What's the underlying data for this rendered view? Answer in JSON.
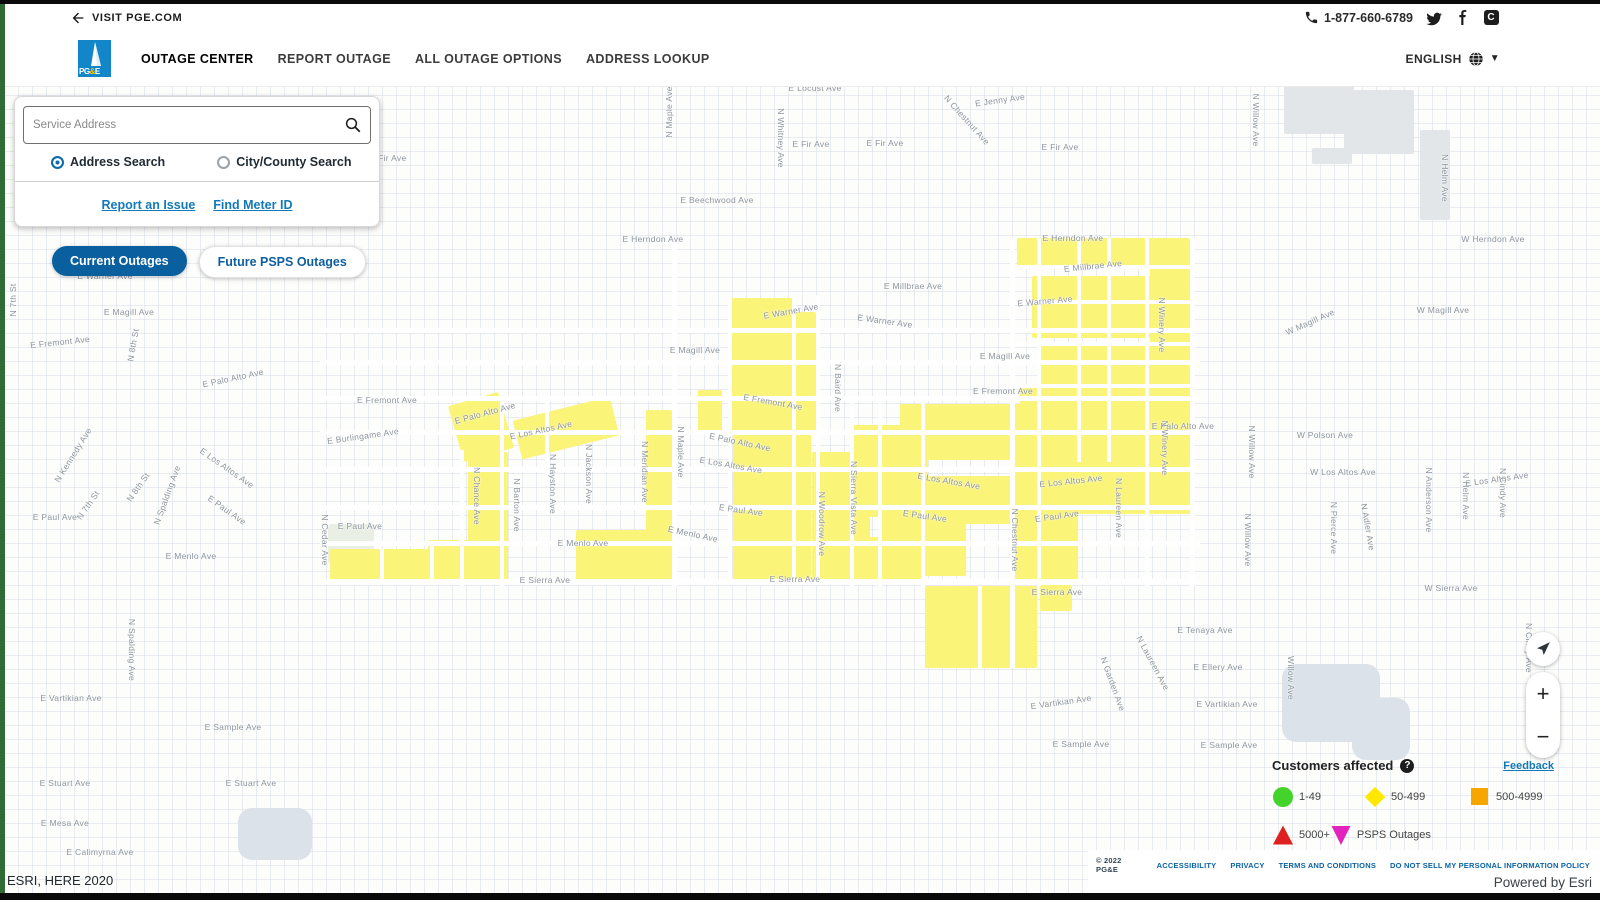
{
  "topbar": {
    "back_label": "VISIT PGE.COM",
    "phone": "1-877-660-6789"
  },
  "header": {
    "logo_text": "PG&E",
    "nav": [
      "OUTAGE CENTER",
      "REPORT OUTAGE",
      "ALL OUTAGE OPTIONS",
      "ADDRESS LOOKUP"
    ],
    "language": "ENGLISH"
  },
  "search": {
    "placeholder": "Service Address",
    "radio_address": "Address Search",
    "radio_city": "City/County Search",
    "link_report": "Report an Issue",
    "link_meter": "Find Meter ID"
  },
  "toggles": {
    "current": "Current Outages",
    "future": "Future PSPS Outages"
  },
  "controls": {
    "zoom_in": "+",
    "zoom_out": "−"
  },
  "legend": {
    "title": "Customers affected",
    "help": "?",
    "feedback": "Feedback",
    "items": [
      {
        "shape": "circle",
        "color": "#43d32b",
        "label": "1-49",
        "w": 92
      },
      {
        "shape": "diamond",
        "color": "#ffe800",
        "label": "50-499",
        "w": 105
      },
      {
        "shape": "square",
        "color": "#f7a600",
        "label": "500-4999",
        "w": 91
      },
      {
        "shape": "triangle-up",
        "color": "#df2020",
        "label": "5000+",
        "w": 0
      },
      {
        "shape": "triangle-down",
        "color": "#e323be",
        "label": "PSPS Outages",
        "w": 120
      }
    ],
    "resource_link": "Community Resource Center"
  },
  "footer": {
    "copyright": "© 2022 PG&E",
    "links": [
      "ACCESSIBILITY",
      "PRIVACY",
      "TERMS AND CONDITIONS",
      "DO NOT SELL MY PERSONAL INFORMATION POLICY"
    ],
    "powered": "Powered by Esri"
  },
  "map": {
    "attribution": "ESRI, HERE 2020",
    "colors": {
      "outage": "#faf478",
      "street": "#ffffff",
      "building": "#e3e6e9",
      "water": "#dbe2ea",
      "green": "#e9efe4"
    },
    "outage_areas": [
      [
        455,
        398,
        52,
        58,
        -16
      ],
      [
        468,
        452,
        40,
        128
      ],
      [
        428,
        540,
        56,
        44
      ],
      [
        330,
        549,
        100,
        36
      ],
      [
        516,
        408,
        100,
        40,
        -14
      ],
      [
        576,
        530,
        92,
        54
      ],
      [
        646,
        410,
        26,
        172
      ],
      [
        698,
        390,
        24,
        42
      ],
      [
        730,
        298,
        64,
        136
      ],
      [
        796,
        312,
        20,
        120
      ],
      [
        733,
        432,
        78,
        148
      ],
      [
        812,
        452,
        58,
        128
      ],
      [
        865,
        537,
        58,
        46
      ],
      [
        852,
        425,
        76,
        92
      ],
      [
        900,
        404,
        292,
        56
      ],
      [
        1010,
        452,
        182,
        62
      ],
      [
        902,
        476,
        112,
        48
      ],
      [
        878,
        498,
        88,
        78
      ],
      [
        1014,
        498,
        64,
        84
      ],
      [
        925,
        586,
        112,
        82
      ],
      [
        1040,
        585,
        32,
        26
      ],
      [
        1017,
        238,
        172,
        28
      ],
      [
        1150,
        238,
        40,
        190
      ],
      [
        1032,
        276,
        150,
        62
      ],
      [
        1040,
        345,
        145,
        52
      ],
      [
        1020,
        388,
        168,
        36
      ],
      [
        1163,
        250,
        30,
        24
      ]
    ],
    "street_channels": [
      [
        320,
        328,
        880,
        5
      ],
      [
        320,
        360,
        880,
        5
      ],
      [
        320,
        396,
        880,
        5
      ],
      [
        320,
        430,
        880,
        5
      ],
      [
        320,
        467,
        880,
        5
      ],
      [
        320,
        505,
        880,
        5
      ],
      [
        320,
        541,
        880,
        5
      ],
      [
        320,
        579,
        880,
        6
      ],
      [
        1008,
        265,
        190,
        4
      ],
      [
        1008,
        300,
        190,
        4
      ],
      [
        1008,
        342,
        190,
        4
      ],
      [
        1008,
        384,
        190,
        4
      ],
      [
        672,
        240,
        5,
        346
      ],
      [
        728,
        295,
        4,
        290
      ],
      [
        792,
        295,
        4,
        290
      ],
      [
        816,
        295,
        4,
        290
      ],
      [
        850,
        400,
        4,
        186
      ],
      [
        878,
        400,
        4,
        186
      ],
      [
        921,
        400,
        4,
        186
      ],
      [
        1010,
        238,
        5,
        430
      ],
      [
        1037,
        238,
        4,
        348
      ],
      [
        1077,
        238,
        4,
        224
      ],
      [
        1107,
        238,
        4,
        224
      ],
      [
        1145,
        238,
        4,
        348
      ],
      [
        1190,
        238,
        5,
        348
      ],
      [
        500,
        400,
        4,
        186
      ],
      [
        545,
        400,
        4,
        80
      ],
      [
        460,
        450,
        4,
        136
      ],
      [
        978,
        586,
        4,
        82
      ],
      [
        430,
        545,
        4,
        40
      ],
      [
        380,
        549,
        4,
        36
      ]
    ],
    "buildings": [
      [
        1284,
        82,
        70,
        52
      ],
      [
        1344,
        90,
        70,
        64
      ],
      [
        1420,
        130,
        30,
        90
      ],
      [
        1312,
        148,
        40,
        16
      ]
    ],
    "water": [
      [
        1282,
        664,
        98,
        78
      ],
      [
        1352,
        698,
        58,
        62
      ],
      [
        238,
        808,
        74,
        52
      ]
    ],
    "green_areas": [
      [
        328,
        524,
        46,
        40
      ]
    ],
    "labels": [
      {
        "t": "E Locust Ave",
        "x": 810,
        "y": 88
      },
      {
        "t": "N Maple Ave",
        "x": 664,
        "y": 112,
        "r": -90
      },
      {
        "t": "E Jenny Ave",
        "x": 995,
        "y": 100,
        "r": -8
      },
      {
        "t": "N Chestnut Ave",
        "x": 962,
        "y": 120,
        "r": 48
      },
      {
        "t": "E Fir Ave",
        "x": 806,
        "y": 144
      },
      {
        "t": "E Fir Ave",
        "x": 880,
        "y": 143
      },
      {
        "t": "E Fir Ave",
        "x": 1055,
        "y": 147
      },
      {
        "t": "E Fir Ave",
        "x": 383,
        "y": 158
      },
      {
        "t": "N Whitney Ave",
        "x": 776,
        "y": 138,
        "r": 90
      },
      {
        "t": "E Beechwood Ave",
        "x": 712,
        "y": 200
      },
      {
        "t": "N Willow Ave",
        "x": 1251,
        "y": 120,
        "r": 90
      },
      {
        "t": "N Helm Ave",
        "x": 1440,
        "y": 178,
        "r": 90
      },
      {
        "t": "W Herndon Ave",
        "x": 1488,
        "y": 239
      },
      {
        "t": "E Herndon Ave",
        "x": 648,
        "y": 239
      },
      {
        "t": "E Herndon Ave",
        "x": 1068,
        "y": 238
      },
      {
        "t": "E Millbrae Ave",
        "x": 908,
        "y": 286
      },
      {
        "t": "E Millbrae Ave",
        "x": 1088,
        "y": 266,
        "r": -6
      },
      {
        "t": "E Warner Ave",
        "x": 100,
        "y": 276
      },
      {
        "t": "E Warner Ave",
        "x": 786,
        "y": 311,
        "r": -10
      },
      {
        "t": "E Warner Ave",
        "x": 880,
        "y": 321,
        "r": 8
      },
      {
        "t": "E Warner Ave",
        "x": 1040,
        "y": 301,
        "r": -5
      },
      {
        "t": "E Magill Ave",
        "x": 124,
        "y": 312
      },
      {
        "t": "E Magill Ave",
        "x": 690,
        "y": 350
      },
      {
        "t": "E Magill Ave",
        "x": 1000,
        "y": 356
      },
      {
        "t": "W Magill Ave",
        "x": 1305,
        "y": 322,
        "r": -24
      },
      {
        "t": "W Magill Ave",
        "x": 1438,
        "y": 310
      },
      {
        "t": "E Fremont Ave",
        "x": 55,
        "y": 342,
        "r": -6
      },
      {
        "t": "E Fremont Ave",
        "x": 382,
        "y": 400
      },
      {
        "t": "E Fremont Ave",
        "x": 768,
        "y": 402,
        "r": 10
      },
      {
        "t": "E Fremont Ave",
        "x": 998,
        "y": 391
      },
      {
        "t": "N 7th St",
        "x": 8,
        "y": 300,
        "r": -90
      },
      {
        "t": "N 8th St",
        "x": 128,
        "y": 345,
        "r": -80
      },
      {
        "t": "N Kennedy Ave",
        "x": 68,
        "y": 455,
        "r": -58
      },
      {
        "t": "E Palo Alto Ave",
        "x": 228,
        "y": 378,
        "r": -12
      },
      {
        "t": "E Palo Alto Ave",
        "x": 480,
        "y": 413,
        "r": -15
      },
      {
        "t": "E Palo Alto Ave",
        "x": 735,
        "y": 442,
        "r": 12
      },
      {
        "t": "E Palo Alto Ave",
        "x": 1178,
        "y": 426
      },
      {
        "t": "E Burlingame Ave",
        "x": 358,
        "y": 436,
        "r": -8
      },
      {
        "t": "E Los Altos Ave",
        "x": 536,
        "y": 430,
        "r": -12
      },
      {
        "t": "E Los Altos Ave",
        "x": 222,
        "y": 468,
        "r": 35
      },
      {
        "t": "E Los Altos Ave",
        "x": 726,
        "y": 465,
        "r": 10
      },
      {
        "t": "E Los Altos Ave",
        "x": 944,
        "y": 481,
        "r": 10
      },
      {
        "t": "E Los Altos Ave",
        "x": 1066,
        "y": 481,
        "r": -6
      },
      {
        "t": "W Los Altos Ave",
        "x": 1338,
        "y": 472
      },
      {
        "t": "E Los Altos Ave",
        "x": 1492,
        "y": 479,
        "r": -8
      },
      {
        "t": "W Polson Ave",
        "x": 1320,
        "y": 435
      },
      {
        "t": "E Paul Ave",
        "x": 50,
        "y": 517
      },
      {
        "t": "E Paul Ave",
        "x": 222,
        "y": 510,
        "r": 35
      },
      {
        "t": "E Paul Ave",
        "x": 736,
        "y": 510,
        "r": 8
      },
      {
        "t": "E Paul Ave",
        "x": 920,
        "y": 516,
        "r": 8
      },
      {
        "t": "E Paul Ave",
        "x": 1052,
        "y": 516,
        "r": -8
      },
      {
        "t": "E Paul Ave",
        "x": 355,
        "y": 526
      },
      {
        "t": "E Menlo Ave",
        "x": 186,
        "y": 556
      },
      {
        "t": "E Menlo Ave",
        "x": 578,
        "y": 543
      },
      {
        "t": "E Menlo Ave",
        "x": 688,
        "y": 534,
        "r": 12
      },
      {
        "t": "E Sierra Ave",
        "x": 540,
        "y": 580
      },
      {
        "t": "E Sierra Ave",
        "x": 790,
        "y": 579
      },
      {
        "t": "E Sierra Ave",
        "x": 1052,
        "y": 592
      },
      {
        "t": "W Sierra Ave",
        "x": 1446,
        "y": 588
      },
      {
        "t": "N Cedar Ave",
        "x": 320,
        "y": 540,
        "r": 90
      },
      {
        "t": "N Spalding Ave",
        "x": 162,
        "y": 495,
        "r": -70
      },
      {
        "t": "N 7th St",
        "x": 83,
        "y": 505,
        "r": -55
      },
      {
        "t": "N 8th St",
        "x": 133,
        "y": 487,
        "r": -55
      },
      {
        "t": "N Chance Ave",
        "x": 472,
        "y": 496,
        "r": 90
      },
      {
        "t": "N Barton Ave",
        "x": 512,
        "y": 505,
        "r": 90
      },
      {
        "t": "N Hayston Ave",
        "x": 548,
        "y": 484,
        "r": 90
      },
      {
        "t": "N Jackson Ave",
        "x": 584,
        "y": 474,
        "r": 90
      },
      {
        "t": "N Meridian Ave",
        "x": 640,
        "y": 472,
        "r": 90
      },
      {
        "t": "N Maple Ave",
        "x": 676,
        "y": 452,
        "r": 90
      },
      {
        "t": "N Baird Ave",
        "x": 833,
        "y": 388,
        "r": 90
      },
      {
        "t": "N Woodrow Ave",
        "x": 817,
        "y": 524,
        "r": 90
      },
      {
        "t": "N Sierra Vista Ave",
        "x": 849,
        "y": 498,
        "r": 90
      },
      {
        "t": "N Winery Ave",
        "x": 1157,
        "y": 325,
        "r": 90
      },
      {
        "t": "N Winery Ave",
        "x": 1160,
        "y": 448,
        "r": 90
      },
      {
        "t": "N Chestnut Ave",
        "x": 1010,
        "y": 540,
        "r": 90
      },
      {
        "t": "N Laureen Ave",
        "x": 1114,
        "y": 508,
        "r": 90
      },
      {
        "t": "N Willow Ave",
        "x": 1247,
        "y": 452,
        "r": 90
      },
      {
        "t": "N Willow Ave",
        "x": 1243,
        "y": 540,
        "r": 90
      },
      {
        "t": "N Pierce Ave",
        "x": 1329,
        "y": 528,
        "r": 90
      },
      {
        "t": "N Adler Ave",
        "x": 1363,
        "y": 527,
        "r": 80
      },
      {
        "t": "N Anderson Ave",
        "x": 1424,
        "y": 500,
        "r": 90
      },
      {
        "t": "N Helm Ave",
        "x": 1461,
        "y": 496,
        "r": 90
      },
      {
        "t": "N Cindy Ave",
        "x": 1498,
        "y": 493,
        "r": 90
      },
      {
        "t": "N Cindy Ave",
        "x": 1524,
        "y": 648,
        "r": 90
      },
      {
        "t": "Willow Ave",
        "x": 1286,
        "y": 678,
        "r": 90
      },
      {
        "t": "N Laureen Ave",
        "x": 1148,
        "y": 663,
        "r": 62
      },
      {
        "t": "N Garden Ave",
        "x": 1108,
        "y": 684,
        "r": 70
      },
      {
        "t": "E Tenaya Ave",
        "x": 1200,
        "y": 630
      },
      {
        "t": "E Ellery Ave",
        "x": 1213,
        "y": 667
      },
      {
        "t": "E Vartikian Ave",
        "x": 1222,
        "y": 704
      },
      {
        "t": "E Vartikian Ave",
        "x": 1056,
        "y": 702,
        "r": -8
      },
      {
        "t": "E Vartikian Ave",
        "x": 66,
        "y": 698
      },
      {
        "t": "E Sample Ave",
        "x": 1224,
        "y": 745
      },
      {
        "t": "E Sample Ave",
        "x": 1076,
        "y": 744
      },
      {
        "t": "E Sample Ave",
        "x": 228,
        "y": 727
      },
      {
        "t": "N Spalding Ave",
        "x": 127,
        "y": 650,
        "r": 90
      },
      {
        "t": "E Stuart Ave",
        "x": 60,
        "y": 783
      },
      {
        "t": "E Stuart Ave",
        "x": 246,
        "y": 783
      },
      {
        "t": "E Mesa Ave",
        "x": 60,
        "y": 823
      },
      {
        "t": "E Calimyrna Ave",
        "x": 95,
        "y": 852
      }
    ]
  }
}
